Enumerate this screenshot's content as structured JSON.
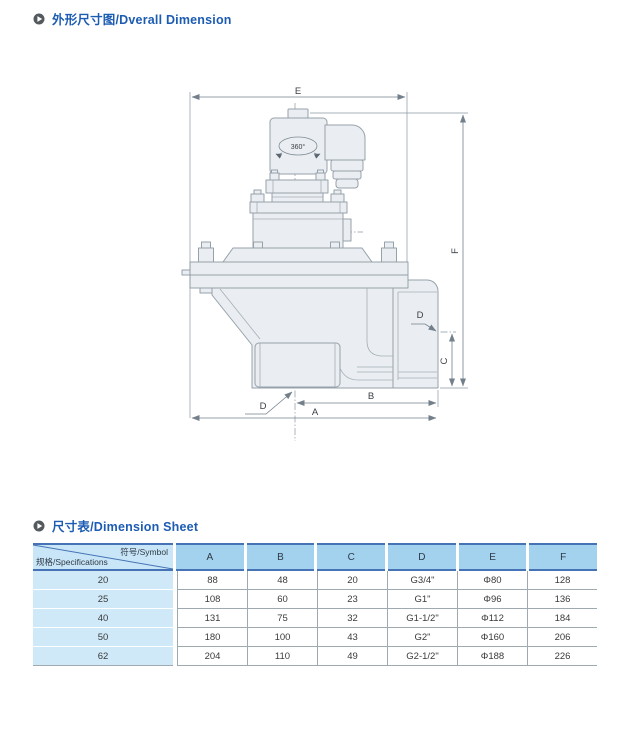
{
  "sections": [
    {
      "title": "外形尺寸图/Dverall Dimension"
    },
    {
      "title": "尺寸表/Dimension Sheet"
    }
  ],
  "drawing": {
    "labels": {
      "e": "E",
      "f": "F",
      "a": "A",
      "b": "B",
      "c": "C",
      "d_outlet": "D",
      "d_bottom": "D",
      "rotation": "360°"
    }
  },
  "table": {
    "corner": {
      "top_right": "符号/Symbol",
      "bottom_left": "规格/Specifications"
    },
    "columns": [
      "A",
      "B",
      "C",
      "D",
      "E",
      "F"
    ],
    "rows": [
      {
        "spec": "20",
        "values": [
          "88",
          "48",
          "20",
          "G3/4\"",
          "Φ80",
          "128"
        ]
      },
      {
        "spec": "25",
        "values": [
          "108",
          "60",
          "23",
          "G1\"",
          "Φ96",
          "136"
        ]
      },
      {
        "spec": "40",
        "values": [
          "131",
          "75",
          "32",
          "G1-1/2\"",
          "Φ112",
          "184"
        ]
      },
      {
        "spec": "50",
        "values": [
          "180",
          "100",
          "43",
          "G2\"",
          "Φ160",
          "206"
        ]
      },
      {
        "spec": "62",
        "values": [
          "204",
          "110",
          "49",
          "G2-1/2\"",
          "Φ188",
          "226"
        ]
      }
    ]
  },
  "colors": {
    "title_blue": "#1d5cb3",
    "table_border_blue": "#4673b5",
    "header_fill": "#a3d2ee",
    "corner_fill": "#c8e6f8",
    "spec_column_fill": "#cfe9f8",
    "grid_gray": "#9fa9b0",
    "drawing_fill": "#eaeef2",
    "drawing_stroke": "#95a1ab"
  }
}
